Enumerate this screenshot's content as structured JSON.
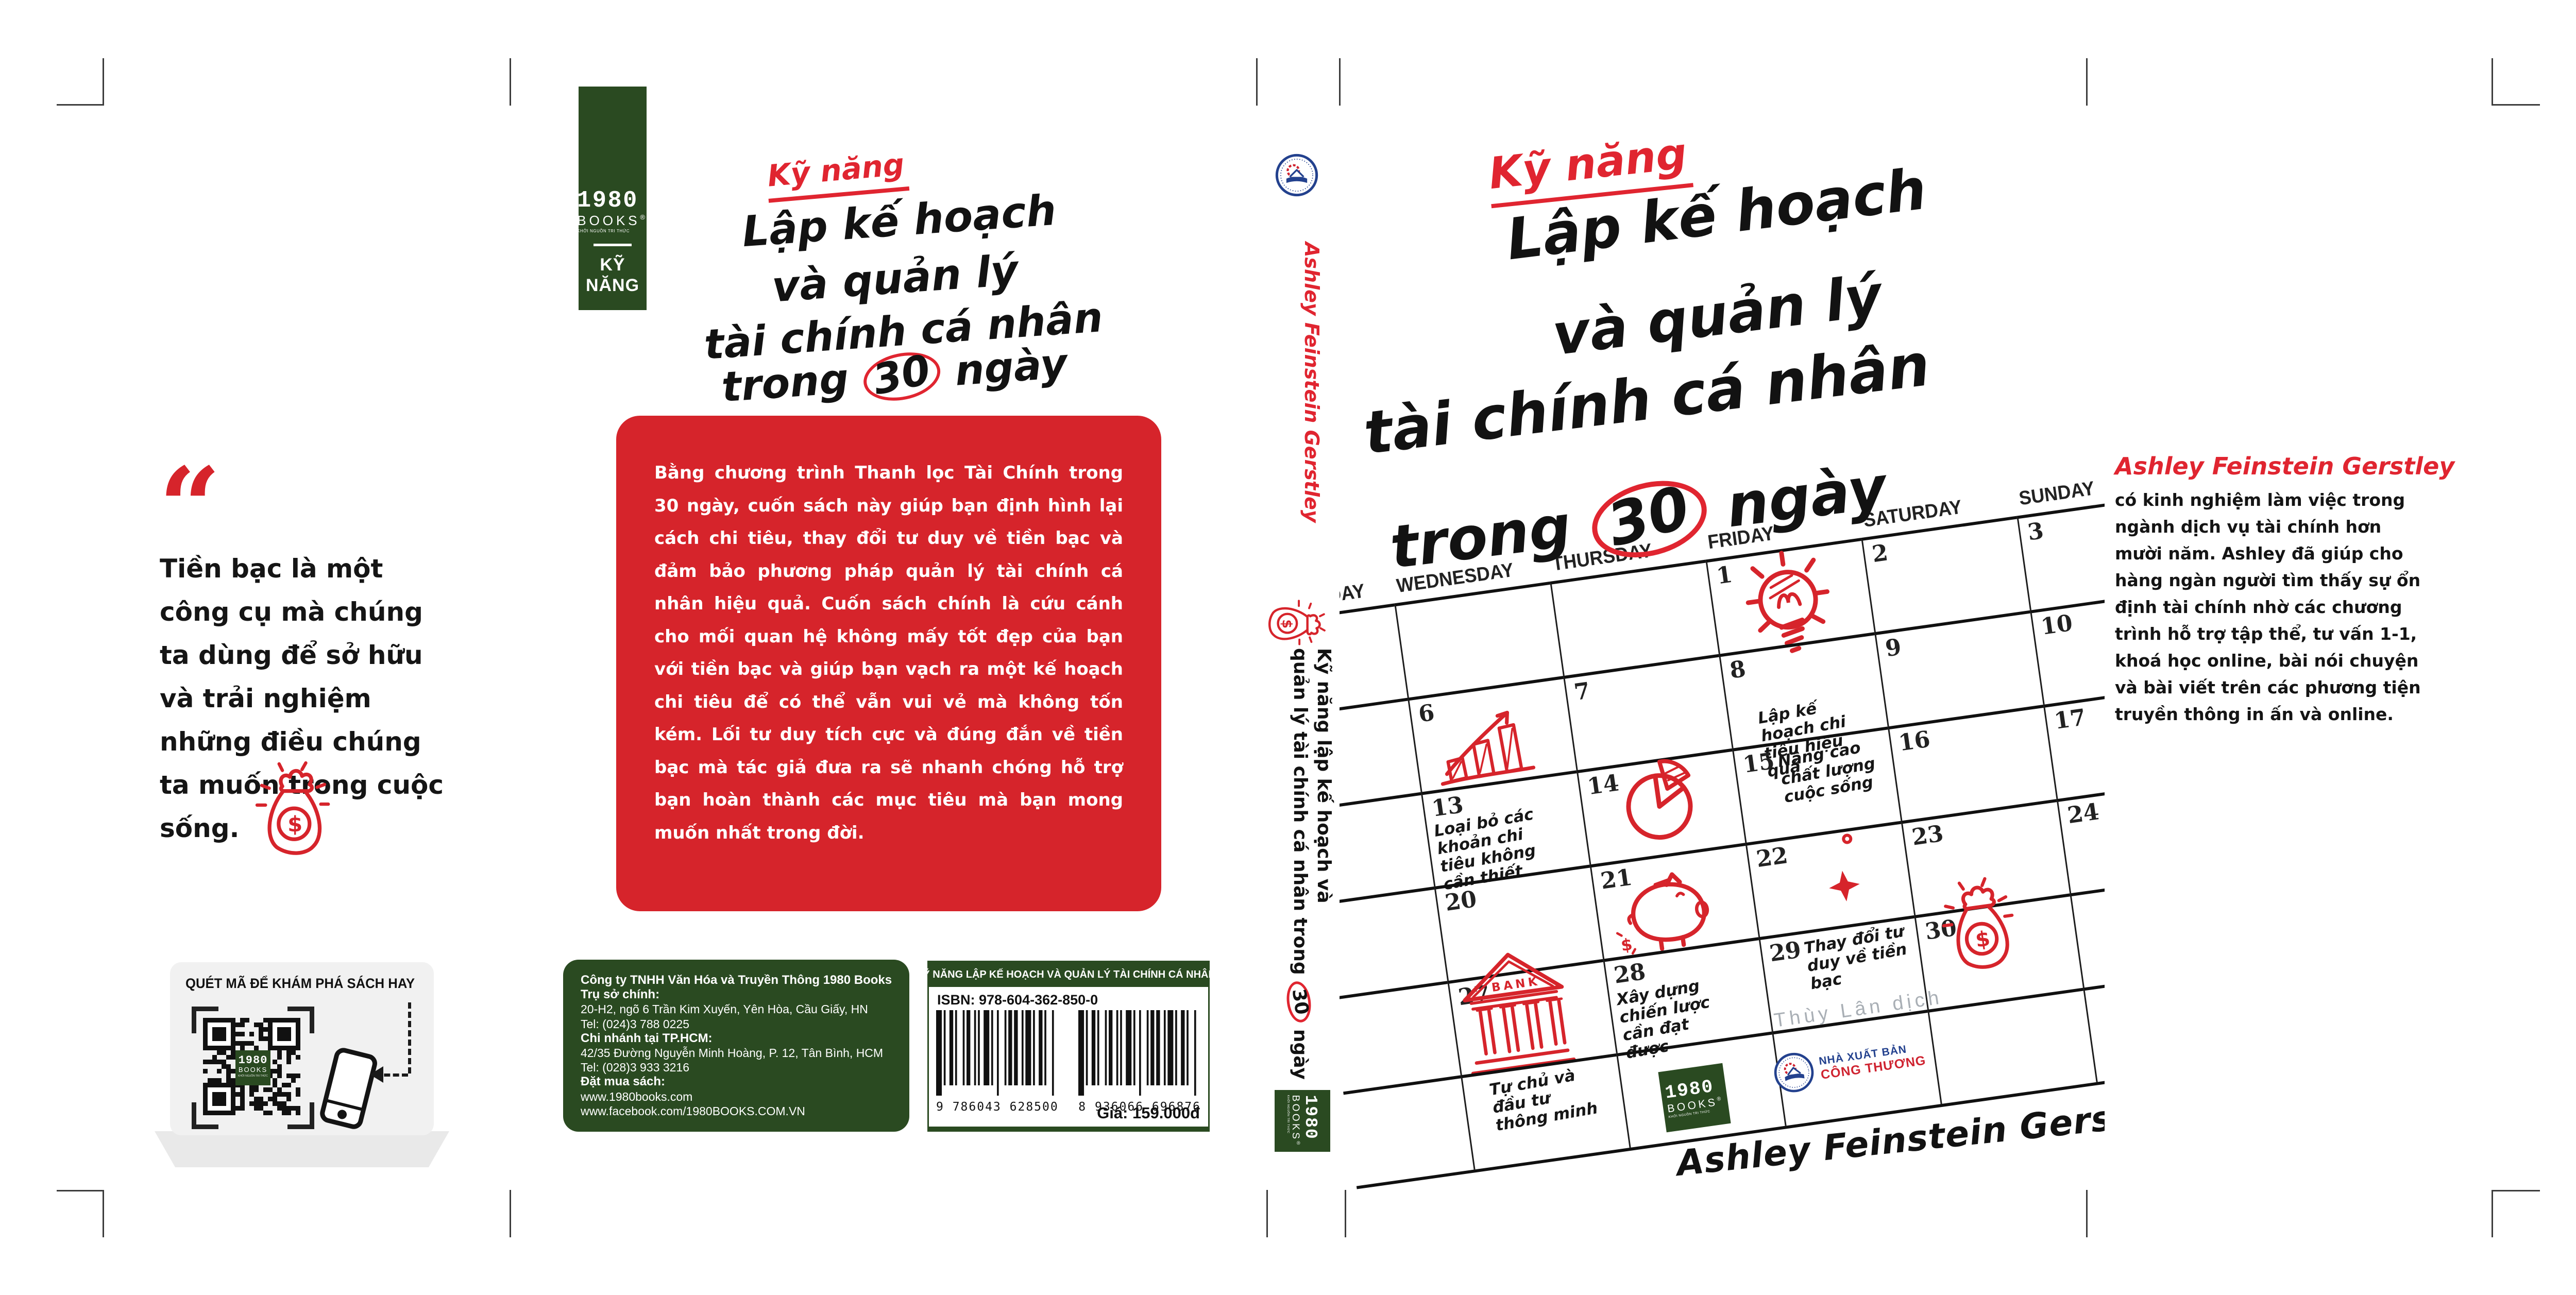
{
  "colors": {
    "red": "#d6242b",
    "green": "#2a4a21",
    "gray_translator": "#a9afb5",
    "nxb_blue": "#23418e",
    "nxb_red": "#cf2330"
  },
  "brand": {
    "year": "1980",
    "books": "BOOKS",
    "reg": "®",
    "tagline": "KHỞI NGUỒN TRI THỨC"
  },
  "book_title": {
    "kicker": "Kỹ năng",
    "line1": "Lập kế hoạch",
    "line2": "và quản lý",
    "line3": "tài chính cá nhân",
    "line4_pre": "trong",
    "line4_num": "30",
    "line4_post": "ngày"
  },
  "left_flap": {
    "quote_mark": "“",
    "quote": "Tiền bạc là một công cụ mà chúng ta dùng để sở hữu và trải nghiệm những điều chúng ta muốn trong cuộc sống.",
    "money_bag_icon": "money-bag-icon",
    "qr_card": {
      "title": "QUÉT MÃ ĐỂ KHÁM PHÁ SÁCH HAY",
      "phone_icon": "smartphone-icon",
      "qr_icon": "qr-code"
    }
  },
  "back_cover": {
    "tag": {
      "category_line1": "KỸ",
      "category_line2": "NĂNG"
    },
    "blurb": "Bằng chương trình Thanh lọc Tài Chính trong 30 ngày, cuốn sách này giúp bạn định hình lại cách chi tiêu, thay đổi tư duy về tiền bạc và đảm bảo phương pháp quản lý tài chính cá nhân hiệu quả. Cuốn sách chính là cứu cánh cho mối quan hệ không mấy tốt đẹp của bạn với tiền bạc và giúp bạn vạch ra một kế hoạch chi tiêu để có thể vẫn vui vẻ mà không tốn kém. Lối tư duy tích cực và đúng đắn về tiền bạc mà tác giả đưa ra sẽ nhanh chóng hỗ trợ bạn hoàn thành các mục tiêu mà bạn mong muốn nhất trong đời.",
    "publisher_info": {
      "lines": [
        {
          "text": "Công ty TNHH Văn Hóa và Truyền Thông 1980 Books",
          "bold": true
        },
        {
          "text": "Trụ sở chính:",
          "bold": true
        },
        {
          "text": "20-H2, ngõ 6 Trần Kim Xuyến, Yên Hòa, Cầu Giấy, HN",
          "bold": false
        },
        {
          "text": "Tel: (024)3 788 0225",
          "bold": false
        },
        {
          "text": "Chi nhánh tại TP.HCM:",
          "bold": true
        },
        {
          "text": "42/35 Đường Nguyễn Minh Hoàng, P. 12, Tân Bình, HCM",
          "bold": false
        },
        {
          "text": "Tel: (028)3 933 3216",
          "bold": false
        },
        {
          "text": "Đặt mua sách:",
          "bold": true
        },
        {
          "text": "www.1980books.com",
          "bold": false
        },
        {
          "text": "www.facebook.com/1980BOOKS.COM.VN",
          "bold": false
        }
      ]
    },
    "barcode": {
      "header": "KỸ NĂNG LẬP KẾ HOẠCH VÀ QUẢN LÝ TÀI CHÍNH CÁ NHÂN..",
      "isbn": "ISBN: 978-604-362-850-0",
      "code1": "9 786043 628500",
      "code2": "8 936066 696876",
      "price": "Giá: 159.000đ"
    }
  },
  "spine": {
    "publisher_logo_icon": "cong-thuong-emblem",
    "author": "Ashley Feinstein Gerstley",
    "money_bag_icon": "money-bag-icon",
    "title_line1": "Kỹ năng lập kế hoạch và",
    "title_line2_pre": "quản lý tài chính cá nhân trong",
    "title_line2_num": "30",
    "title_line2_post": "ngày"
  },
  "front_cover": {
    "calendar": {
      "day_headers": [
        "TUESDAY",
        "WEDNESDAY",
        "THURSDAY",
        "FRIDAY",
        "SATURDAY",
        "SUNDAY"
      ],
      "rows": [
        [
          null,
          null,
          null,
          {
            "num": "1",
            "doodle": "lightbulb"
          },
          {
            "num": "2"
          },
          {
            "num": "3"
          }
        ],
        [
          null,
          {
            "num": "6",
            "doodle": "bar-chart"
          },
          {
            "num": "7"
          },
          {
            "num": "8",
            "note": "Lập kế hoạch chi tiêu hiệu quả"
          },
          {
            "num": "9"
          },
          {
            "num": "10"
          }
        ],
        [
          null,
          {
            "num": "13",
            "note": "Loại bỏ các khoản chi tiêu không cần thiết"
          },
          {
            "num": "14",
            "doodle": "pie-chart"
          },
          {
            "num": "15",
            "note": "Nâng cao chất lượng cuộc sống"
          },
          {
            "num": "16"
          },
          {
            "num": "17"
          }
        ],
        [
          null,
          {
            "num": "20"
          },
          {
            "num": "21",
            "doodle": "piggy-bank"
          },
          {
            "num": "22",
            "doodle": "sparkle"
          },
          {
            "num": "23"
          },
          {
            "num": "24"
          }
        ],
        [
          null,
          {
            "num": "27",
            "doodle": "bank"
          },
          {
            "num": "28",
            "note": "Xây dựng chiến lược cần đạt được"
          },
          {
            "num": "29",
            "note": "Thay đổi tư duy về tiền bạc"
          },
          {
            "num": "30",
            "doodle": "money-bag"
          },
          null
        ],
        [
          null,
          {
            "note": "Tự chủ và đầu tư thông minh",
            "extra": true
          },
          null,
          null,
          null,
          null
        ]
      ]
    },
    "translator": "Thùy Lân dịch",
    "nxb_logo": {
      "icon": "cong-thuong-emblem",
      "line1": "NHÀ XUẤT BẢN",
      "line2": "CÔNG THƯƠNG"
    },
    "author_signature": "Ashley Feinstein Gerstley"
  },
  "right_flap": {
    "author_name": "Ashley Feinstein Gerstley",
    "bio": "có kinh nghiệm làm việc trong ngành dịch vụ tài chính hơn mười năm. Ashley đã giúp cho hàng ngàn người tìm thấy sự ổn định tài chính nhờ các chương trình hỗ trợ tập thể, tư vấn 1-1, khoá học online, bài nói chuyện và bài viết trên các phương tiện truyền thông in ấn và online."
  }
}
